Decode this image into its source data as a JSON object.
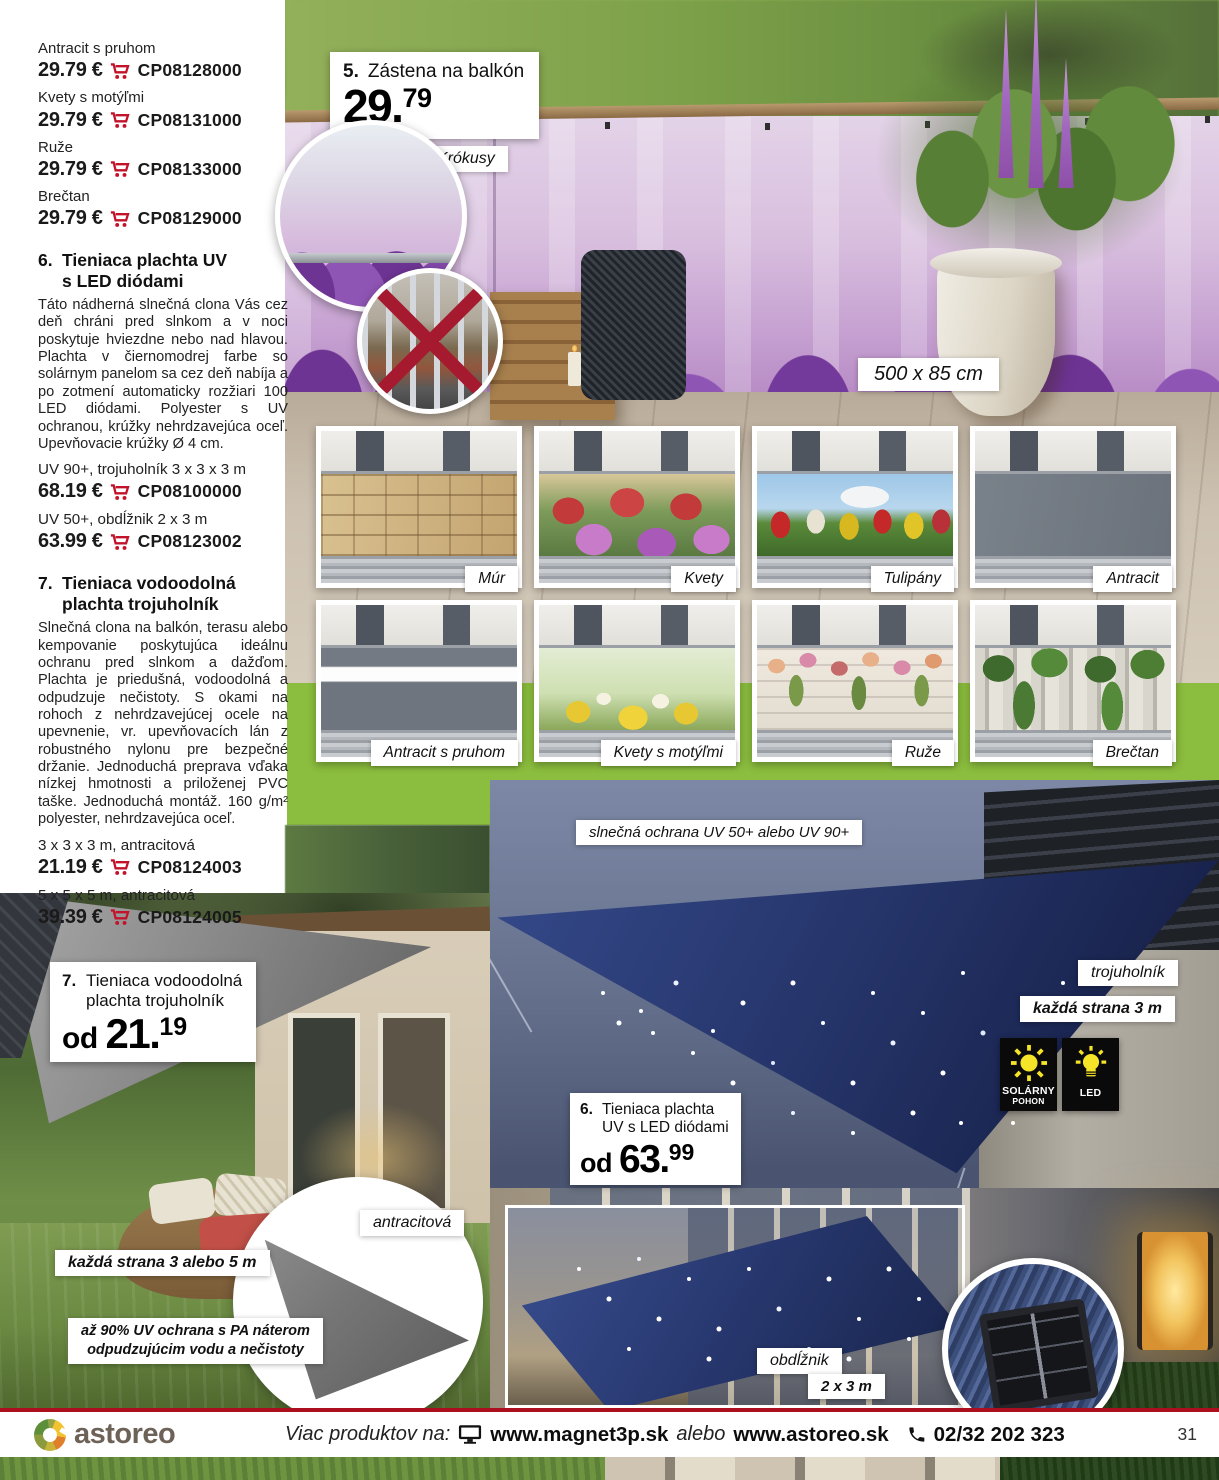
{
  "colors": {
    "cart_red": "#c2132b",
    "accent_green": "#8bbd3e",
    "footer_rule": "#ab0f1e",
    "sail_navy": "#1e2c5e",
    "badge_yellow": "#f5e428"
  },
  "icons": {
    "cart": "red shopping cart",
    "monitor": "computer monitor",
    "phone": "telephone handset",
    "sun": "sun (solar power)",
    "bulb": "light bulb (LED)",
    "cross": "red X (privacy blocked view)"
  },
  "left_column": {
    "price_list": [
      {
        "label": "Antracit s pruhom",
        "price": "29.79 €",
        "code": "CP08128000"
      },
      {
        "label": "Kvety s motýľmi",
        "price": "29.79 €",
        "code": "CP08131000"
      },
      {
        "label": "Ruže",
        "price": "29.79 €",
        "code": "CP08133000"
      },
      {
        "label": "Brečtan",
        "price": "29.79 €",
        "code": "CP08129000"
      }
    ],
    "section6": {
      "number": "6.",
      "title_line1": "Tieniaca plachta UV",
      "title_line2": "s LED diódami",
      "description": "Táto nádherná slnečná clona Vás cez deň chráni pred slnkom a v noci poskytuje hviezdne nebo nad hlavou. Plachta v čiernomodrej farbe so solárnym panelom sa cez deň nabíja a po zotmení automaticky rozžiari 100 LED diódami. Polyester s UV ochranou, krúžky nehrdzavejúca oceľ. Upevňovacie krúžky Ø 4 cm.",
      "variants": [
        {
          "label": "UV 90+, trojuholník 3 x 3 x 3 m",
          "price": "68.19 €",
          "code": "CP08100000"
        },
        {
          "label": "UV 50+, obdĺžnik 2 x 3 m",
          "price": "63.99 €",
          "code": "CP08123002"
        }
      ]
    },
    "section7": {
      "number": "7.",
      "title_line1": "Tieniaca vodoodolná",
      "title_line2": "plachta trojuholník",
      "description": "Slnečná clona na balkón, terasu alebo kempovanie poskytujúca ideálnu ochranu pred slnkom a dažďom. Plachta je priedušná, vodoodolná a odpudzuje nečistoty. S okami na rohoch z nehrdzavejúcej ocele na upevnenie, vr. upevňovacích lán z robustného nylonu pre bezpečné držanie. Jednoduchá preprava vďaka nízkej hmotnosti a priloženej PVC taške. Jednoduchá montáž. 160 g/m² polyester, nehrdzavejúca oceľ.",
      "variants": [
        {
          "label": "3 x 3 x 3 m, antracitová",
          "price": "21.19 €",
          "code": "CP08124003"
        },
        {
          "label": "5 x 5 x 5 m, antracitová",
          "price": "39.39 €",
          "code": "CP08124005"
        }
      ]
    }
  },
  "hero": {
    "badge_number": "5.",
    "badge_title": "Zástena na balkón",
    "price_int": "29.",
    "price_sup": "79",
    "label_variant": "Krókusy",
    "label_size": "500 x 85 cm"
  },
  "thumbs": {
    "row1": [
      {
        "label": "Múr"
      },
      {
        "label": "Kvety"
      },
      {
        "label": "Tulipány"
      },
      {
        "label": "Antracit"
      }
    ],
    "row2": [
      {
        "label": "Antracit s pruhom"
      },
      {
        "label": "Kvety s motýľmi"
      },
      {
        "label": "Ruže"
      },
      {
        "label": "Brečtan"
      }
    ]
  },
  "bottom_left": {
    "badge_number": "7.",
    "badge_title_line1": "Tieniaca vodoodolná",
    "badge_title_line2": "plachta trojuholník",
    "price_prefix": "od ",
    "price_int": "21.",
    "price_sup": "19",
    "label_size": "každá strana 3 alebo 5 m",
    "label_color": "antracitová",
    "label_uv_line1": "až 90% UV ochrana s PA náterom",
    "label_uv_line2": "odpudzujúcim vodu a nečistoty"
  },
  "bottom_right": {
    "label_uv": "slnečná ochrana UV 50+ alebo UV 90+",
    "label_shape": "trojuholník",
    "label_side": "každá strana 3 m",
    "badge_solar_line1": "SOLÁRNY",
    "badge_solar_line2": "POHON",
    "badge_led": "LED",
    "badge_number": "6.",
    "badge_title_line1": "Tieniaca plachta",
    "badge_title_line2": "UV s LED diódami",
    "price_prefix": "od ",
    "price_int": "63.",
    "price_sup": "99",
    "label_rect": "obdĺžnik",
    "label_rect_size": "2 x 3 m"
  },
  "footer": {
    "brand": "astoreo",
    "more_products": "Viac produktov na:",
    "site1": "www.magnet3p.sk",
    "alebo": "alebo",
    "site2": "www.astoreo.sk",
    "phone": "02/32 202 323",
    "page_number": "31"
  }
}
